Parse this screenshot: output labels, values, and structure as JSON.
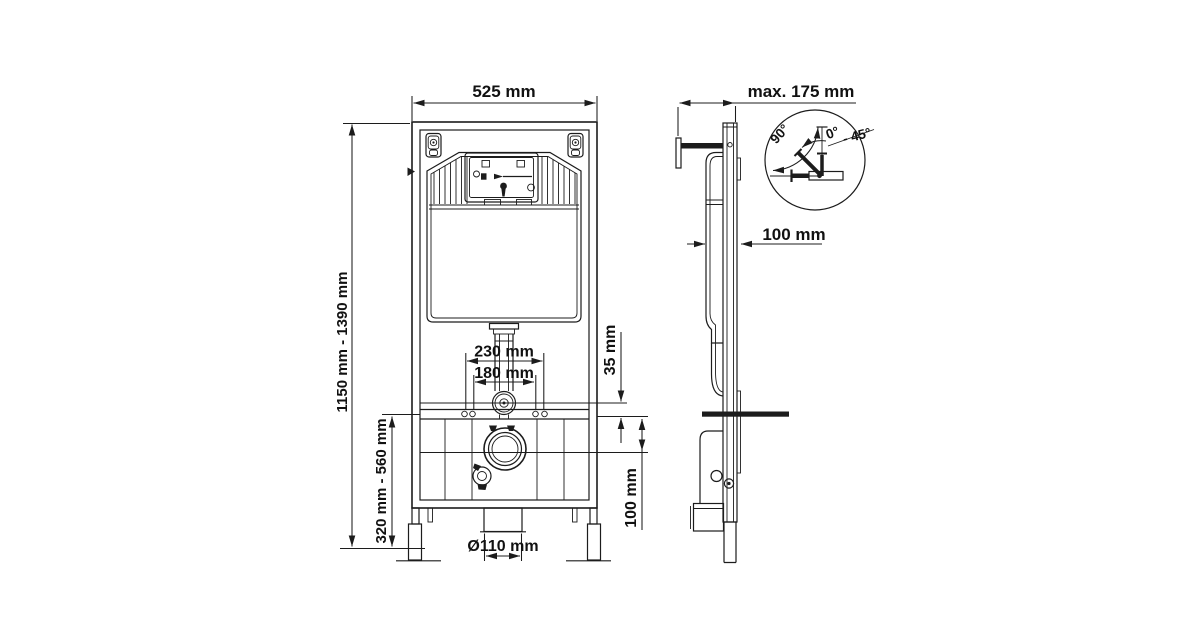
{
  "drawing_type": "installation frame technical drawing",
  "front_view": {
    "label": "front view",
    "dims": {
      "width": "525 mm",
      "height_range": "1150 mm - 1390 mm",
      "lower_height_range": "320 mm - 560 mm",
      "flush_pipe_spacing": "230 mm",
      "bolt_spacing": "180 mm",
      "small_offset": "35 mm",
      "drain_offset": "100 mm",
      "drain_diameter": "Ø110 mm"
    }
  },
  "side_view": {
    "label": "side view",
    "dims": {
      "max_depth": "max. 175 mm",
      "cistern_depth": "100 mm"
    },
    "angle_gauge": {
      "angle_90": "90°",
      "angle_0": "0°",
      "angle_45": "- 45°"
    }
  }
}
